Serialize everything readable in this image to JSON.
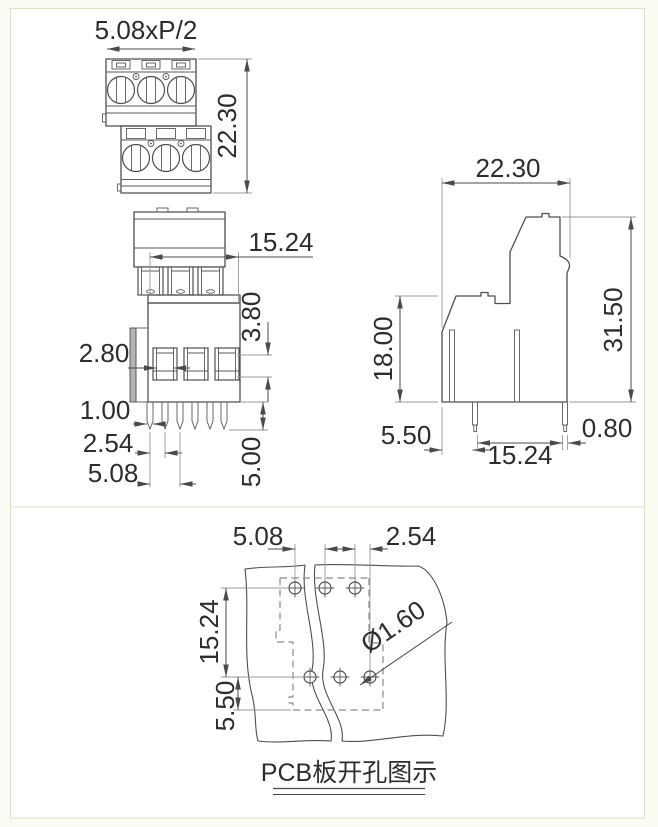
{
  "sheet": {
    "ink_color": "#4a4a4a",
    "panel_border_color": "#dfe3c6",
    "views": {
      "front": {
        "pitch_label": "5.08xP/2",
        "total_height": "22.30"
      },
      "bottom": {
        "body_width": "15.24",
        "clamp_depth": "3.80",
        "slot_width": "2.80",
        "pin_width": "1.00",
        "pin_pitch": "2.54",
        "pole_pitch": "5.08",
        "pin_length": "5.00"
      },
      "side": {
        "body_depth": "22.30",
        "total_height": "31.50",
        "lower_height": "18.00",
        "edge_to_pin": "5.50",
        "row_pitch": "15.24",
        "pin_thickness": "0.80"
      },
      "pcb": {
        "hole_pitch": "5.08",
        "row_offset": "2.54",
        "row_span": "15.24",
        "edge_offset": "5.50",
        "hole_diameter": "Ø1.60",
        "caption": "PCB板开孔图示"
      }
    }
  }
}
